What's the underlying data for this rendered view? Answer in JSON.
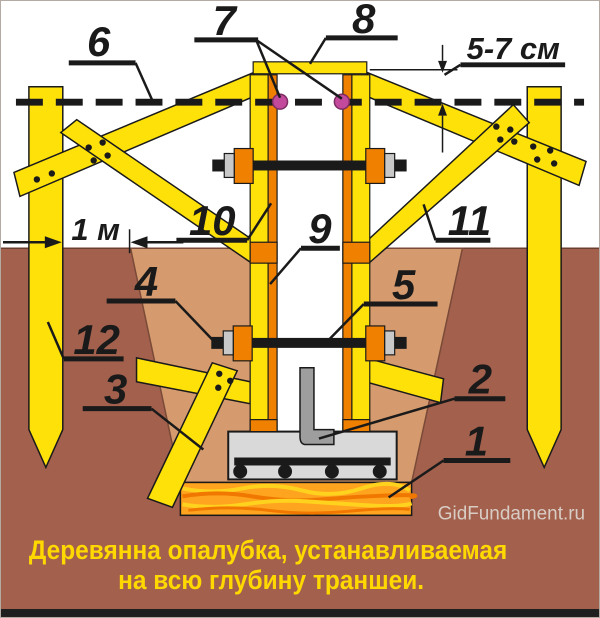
{
  "figure": {
    "caption_line1": "Деревянна опалубка, устанавливаемая",
    "caption_line2": "на всю глубину траншеи.",
    "watermark": "GidFundament.ru"
  },
  "dimensions": {
    "board_above_ground": "5-7 см",
    "stake_to_trench": "1 м"
  },
  "callouts": {
    "c1": "1",
    "c2": "2",
    "c3": "3",
    "c4": "4",
    "c5": "5",
    "c6": "6",
    "c7": "7",
    "c8": "8",
    "c9": "9",
    "c10": "10",
    "c11": "11",
    "c12": "12"
  },
  "colors": {
    "wood_yellow": "#FFE10A",
    "stud_orange": "#F08000",
    "soil_dark": "#A2604D",
    "trench_tan": "#D59B6E",
    "sand_orange": "#FFA41E",
    "sand_streak_light": "#FFD21E",
    "sand_streak_dark": "#F07800",
    "concrete_gray": "#D9D9D9",
    "bolt_gray": "#9E9E9E",
    "washer_gray": "#C8C8C8",
    "nail_pink": "#C2499B",
    "caption_yellow": "#FFD800",
    "watermark_gray": "#D8CCC4",
    "line_black": "#1A1A1A"
  }
}
